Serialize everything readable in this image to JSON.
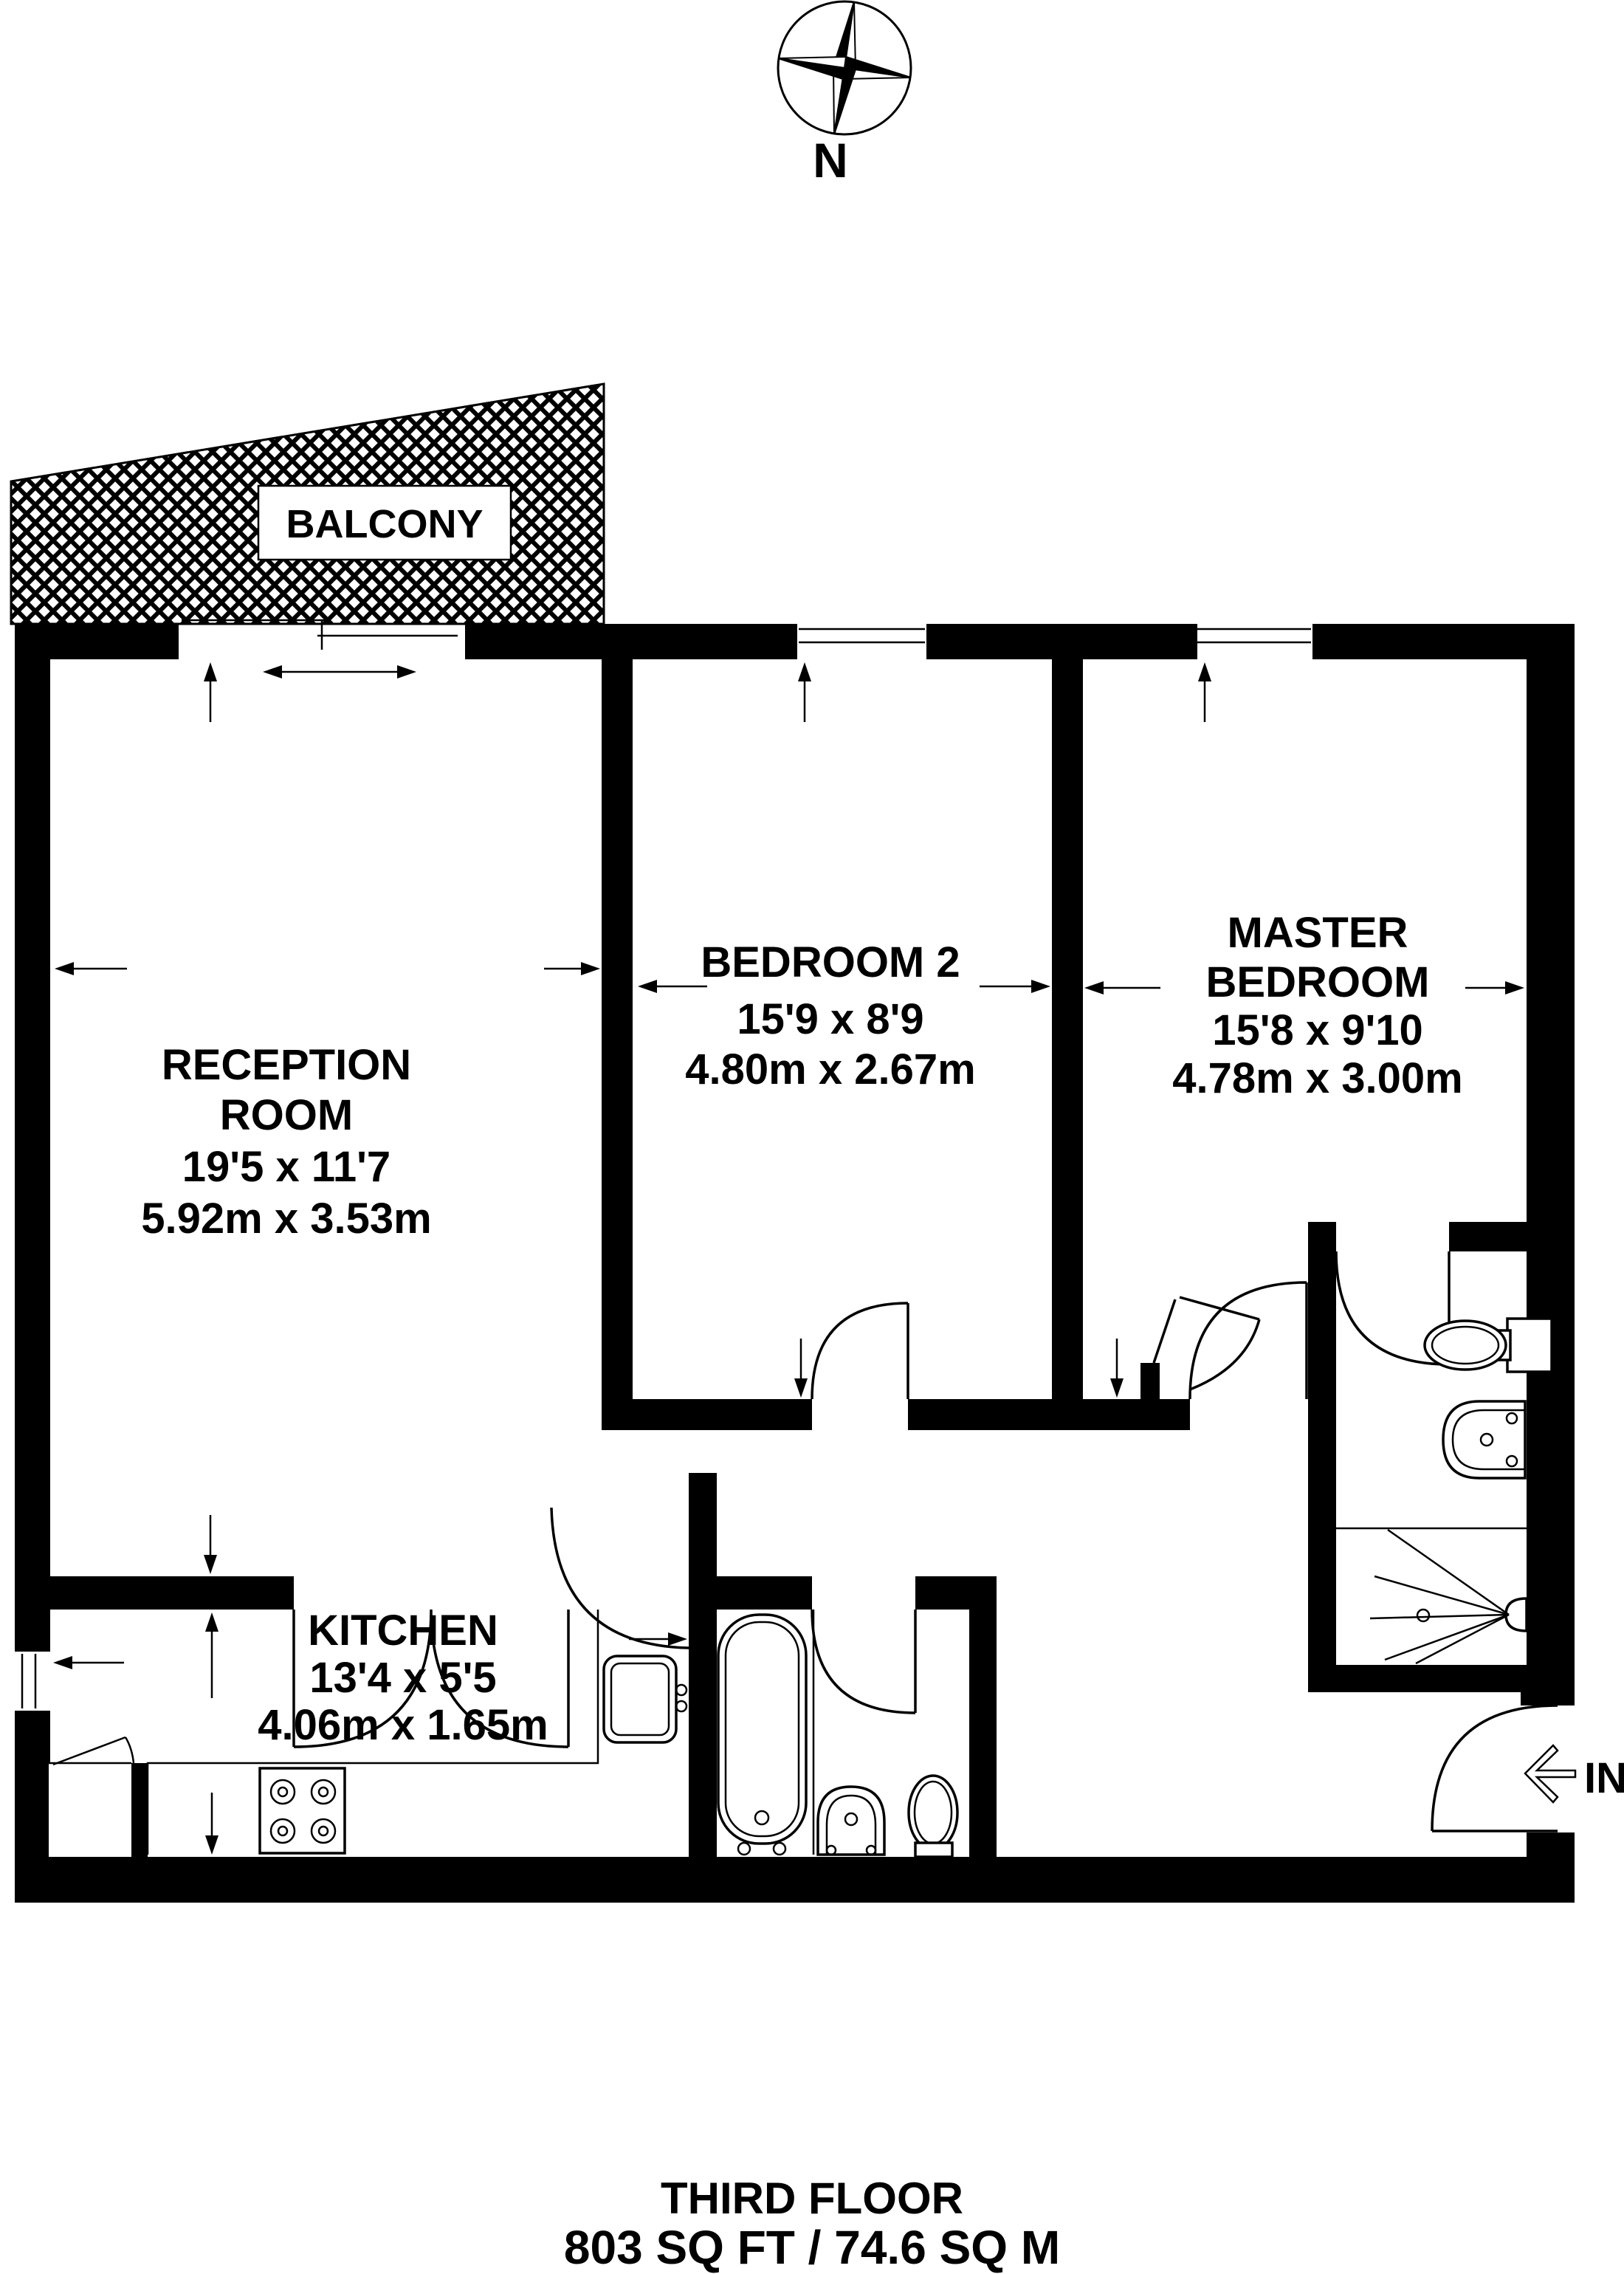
{
  "compass": {
    "north_label": "N"
  },
  "balcony": {
    "label": "BALCONY"
  },
  "rooms": {
    "reception": {
      "line1": "RECEPTION",
      "line2": "ROOM",
      "imperial": "19'5 x 11'7",
      "metric": "5.92m x 3.53m"
    },
    "bedroom2": {
      "name": "BEDROOM 2",
      "imperial": "15'9 x 8'9",
      "metric": "4.80m x 2.67m"
    },
    "master": {
      "line1": "MASTER",
      "line2": "BEDROOM",
      "imperial": "15'8 x 9'10",
      "metric": "4.78m x 3.00m"
    },
    "kitchen": {
      "name": "KITCHEN",
      "imperial": "13'4 x 5'5",
      "metric": "4.06m x 1.65m"
    }
  },
  "entrance": {
    "label": "IN"
  },
  "footer": {
    "floor": "THIRD FLOOR",
    "area": "803 SQ FT / 74.6 SQ M"
  },
  "colors": {
    "wall": "#000000",
    "background": "#ffffff"
  }
}
